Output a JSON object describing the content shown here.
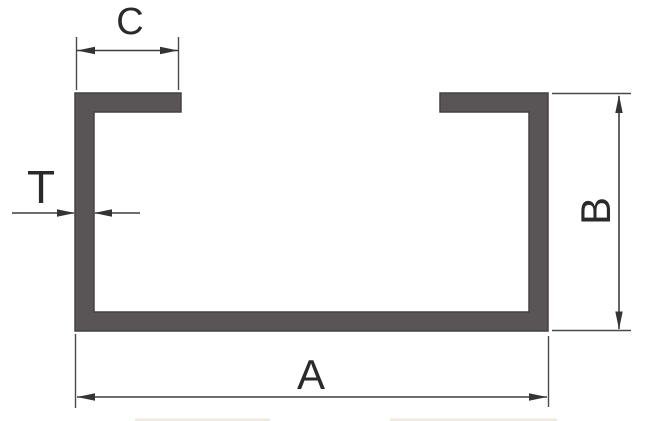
{
  "figure": {
    "labels": {
      "flange_width": "C",
      "thickness": "T",
      "height": "B",
      "total_width": "A"
    },
    "colors": {
      "background": "#ffffff",
      "profile_fill": "#595557",
      "profile_outline": "#454244",
      "dimension_line": "#3d3c3e",
      "label_text": "#2b292b",
      "bottom_strip": "#f2ead9"
    }
  }
}
